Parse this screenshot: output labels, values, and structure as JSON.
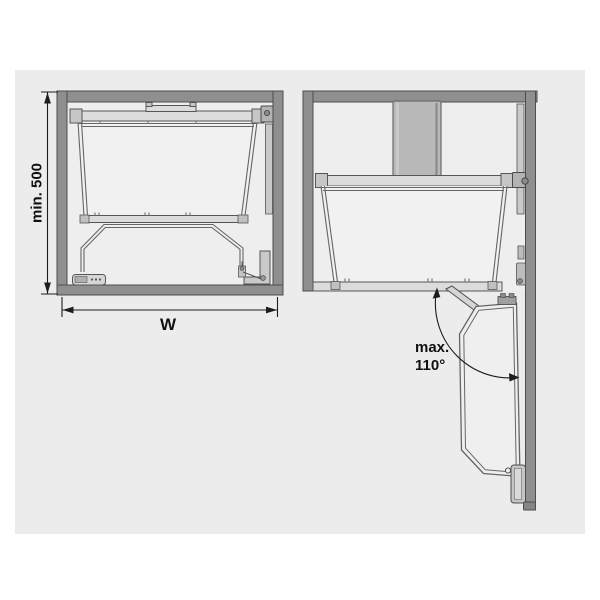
{
  "canvas": {
    "width": 600,
    "height": 600,
    "page_background": "#ffffff",
    "panel_background": "#ececec"
  },
  "colors": {
    "cabinet_wall": "#8f8f8f",
    "cabinet_wall_stroke": "#4d4d4d",
    "hardware_light": "#dcdcdc",
    "hardware_mid": "#b3b3b3",
    "duct_gray": "#b9b9b9",
    "frame_outline": "#666666",
    "dimension_line": "#1c1c1c",
    "label_text": "#111111"
  },
  "left_diagram": {
    "dimension_labels": {
      "height": "min. 500",
      "width": "W"
    }
  },
  "right_diagram": {
    "opening_angle": {
      "line1": "max.",
      "line2": "110°"
    }
  }
}
